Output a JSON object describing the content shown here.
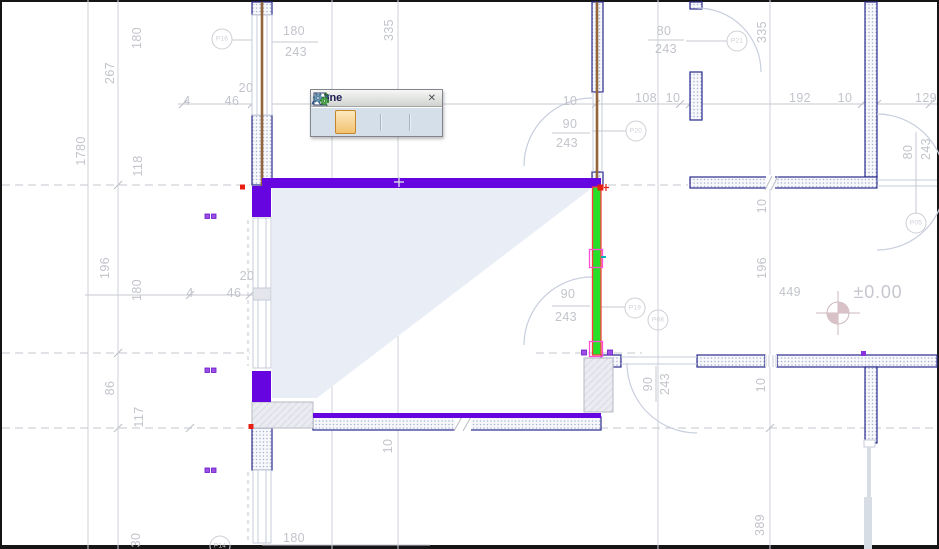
{
  "toolbar": {
    "title": "Zone",
    "close": "✕",
    "buttons": [
      {
        "name": "zone-tool-button",
        "selected": false
      },
      {
        "name": "zone-polygon-method-button",
        "selected": true
      },
      {
        "name": "zone-reference-method-button",
        "selected": false
      },
      {
        "name": "update-zones-button",
        "selected": false
      },
      {
        "name": "zone-settings-button",
        "selected": false
      }
    ]
  },
  "colors": {
    "zone_edge_purple": "#6605e0",
    "selected_wall_green": "#28df28",
    "selection_red": "#e81e10",
    "handle_pink": "#ff4fd8",
    "zone_fill": "#e9eef6",
    "wall_outline_navy": "#2a2a8e",
    "dimension_gray": "#c2c4cb",
    "axis_brown": "#93653a"
  },
  "annotations": [
    {
      "name": "v-dim-180-top",
      "t": "180",
      "x": 137,
      "y": 38,
      "r": 1
    },
    {
      "name": "v-dim-267",
      "t": "267",
      "x": 110,
      "y": 73,
      "r": 1
    },
    {
      "name": "v-dim-1780",
      "t": "1780",
      "x": 81,
      "y": 151,
      "r": 1
    },
    {
      "name": "v-dim-118",
      "t": "118",
      "x": 138,
      "y": 166,
      "r": 1
    },
    {
      "name": "v-dim-335-left",
      "t": "335",
      "x": 389,
      "y": 30,
      "r": 1
    },
    {
      "name": "h-dim-180-p16",
      "t": "180",
      "x": 294,
      "y": 31
    },
    {
      "name": "h-dim-243-p16",
      "t": "243",
      "x": 296,
      "y": 52
    },
    {
      "name": "h-dim-20-top",
      "t": "20",
      "x": 246,
      "y": 88
    },
    {
      "name": "h-dim-4-top",
      "t": "4",
      "x": 187,
      "y": 101
    },
    {
      "name": "h-dim-46-top",
      "t": "46",
      "x": 232,
      "y": 101
    },
    {
      "name": "h-dim-10-door-top",
      "t": "10",
      "x": 570,
      "y": 101
    },
    {
      "name": "h-dim-108",
      "t": "108",
      "x": 646,
      "y": 98
    },
    {
      "name": "h-dim-10-b",
      "t": "10",
      "x": 673,
      "y": 98
    },
    {
      "name": "h-dim-192",
      "t": "192",
      "x": 800,
      "y": 98
    },
    {
      "name": "h-dim-10-c",
      "t": "10",
      "x": 845,
      "y": 98
    },
    {
      "name": "h-dim-129",
      "t": "129",
      "x": 926,
      "y": 98
    },
    {
      "name": "h-dim-80-p21",
      "t": "80",
      "x": 664,
      "y": 31
    },
    {
      "name": "h-dim-243-p21",
      "t": "243",
      "x": 666,
      "y": 49
    },
    {
      "name": "v-dim-335-right",
      "t": "335",
      "x": 762,
      "y": 32,
      "r": 1
    },
    {
      "name": "h-dim-90-p20",
      "t": "90",
      "x": 570,
      "y": 124
    },
    {
      "name": "h-dim-243-p20",
      "t": "243",
      "x": 567,
      "y": 143
    },
    {
      "name": "v-dim-10-right",
      "t": "10",
      "x": 762,
      "y": 206,
      "r": 1
    },
    {
      "name": "v-dim-80-p05",
      "t": "80",
      "x": 908,
      "y": 152,
      "r": 1
    },
    {
      "name": "v-dim-243-p05",
      "t": "243",
      "x": 926,
      "y": 149,
      "r": 1
    },
    {
      "name": "v-dim-196-left",
      "t": "196",
      "x": 105,
      "y": 268,
      "r": 1
    },
    {
      "name": "v-dim-180-mid",
      "t": "180",
      "x": 137,
      "y": 290,
      "r": 1
    },
    {
      "name": "h-dim-20-mid",
      "t": "20",
      "x": 247,
      "y": 276
    },
    {
      "name": "h-dim-4-mid",
      "t": "4",
      "x": 190,
      "y": 293
    },
    {
      "name": "h-dim-46-mid",
      "t": "46",
      "x": 234,
      "y": 293
    },
    {
      "name": "v-dim-196-right",
      "t": "196",
      "x": 762,
      "y": 268,
      "r": 1
    },
    {
      "name": "h-dim-449",
      "t": "449",
      "x": 790,
      "y": 292
    },
    {
      "name": "elevation-value",
      "t": "±0.00",
      "x": 878,
      "y": 292,
      "big": 1
    },
    {
      "name": "h-dim-90-door",
      "t": "90",
      "x": 568,
      "y": 294
    },
    {
      "name": "h-dim-243-door",
      "t": "243",
      "x": 566,
      "y": 317
    },
    {
      "name": "v-dim-86",
      "t": "86",
      "x": 110,
      "y": 388,
      "r": 1
    },
    {
      "name": "v-dim-117",
      "t": "117",
      "x": 139,
      "y": 417,
      "r": 1
    },
    {
      "name": "v-dim-90-bottom",
      "t": "90",
      "x": 648,
      "y": 384,
      "r": 1
    },
    {
      "name": "v-dim-243-bottom",
      "t": "243",
      "x": 665,
      "y": 384,
      "r": 1
    },
    {
      "name": "v-dim-10-bottomleft",
      "t": "10",
      "x": 388,
      "y": 446,
      "r": 1
    },
    {
      "name": "v-dim-10-bottomright",
      "t": "10",
      "x": 761,
      "y": 385,
      "r": 1
    },
    {
      "name": "v-dim-389",
      "t": "389",
      "x": 760,
      "y": 525,
      "r": 1
    },
    {
      "name": "v-dim-30",
      "t": "30",
      "x": 136,
      "y": 540,
      "r": 1
    },
    {
      "name": "h-dim-180-bottom",
      "t": "180",
      "x": 294,
      "y": 538
    }
  ],
  "bubbles": [
    {
      "name": "bubble-P16",
      "t": "P16",
      "x": 222,
      "y": 39
    },
    {
      "name": "bubble-P21",
      "t": "P21",
      "x": 737,
      "y": 41
    },
    {
      "name": "bubble-P20",
      "t": "P20",
      "x": 636,
      "y": 131
    },
    {
      "name": "bubble-P19",
      "t": "P19",
      "x": 635,
      "y": 308
    },
    {
      "name": "bubble-P08",
      "t": "P08",
      "x": 658,
      "y": 320
    },
    {
      "name": "bubble-P05",
      "t": "P05",
      "x": 916,
      "y": 223
    },
    {
      "name": "bubble-P14",
      "t": "P14",
      "x": 220,
      "y": 546
    }
  ]
}
